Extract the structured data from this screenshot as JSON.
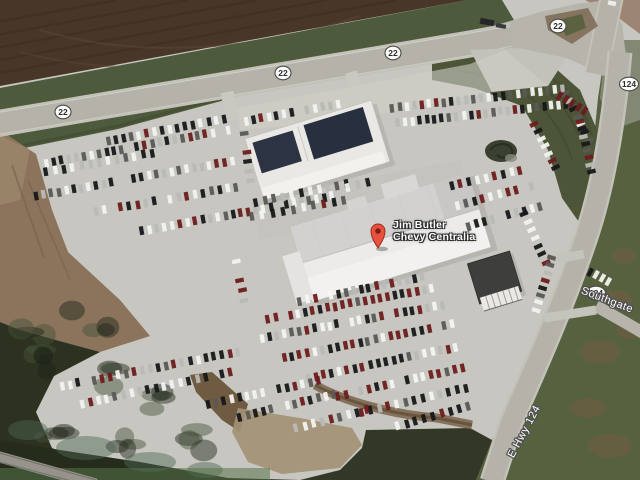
{
  "map": {
    "place_label": {
      "line1": "Jim Butler",
      "line2": "Chevy Centralia"
    },
    "marker": {
      "x": 378,
      "y": 248,
      "color": "#e8513f"
    },
    "route_shields": [
      {
        "label": "22",
        "x": 63,
        "y": 112
      },
      {
        "label": "22",
        "x": 283,
        "y": 73
      },
      {
        "label": "22",
        "x": 393,
        "y": 53
      },
      {
        "label": "22",
        "x": 558,
        "y": 26
      },
      {
        "label": "124",
        "x": 629,
        "y": 84
      },
      {
        "label": "124",
        "x": 596,
        "y": 293
      }
    ],
    "road_labels": [
      {
        "text": "E Hwy 124",
        "x": 527,
        "y": 433,
        "rotate": -62
      },
      {
        "text": "Southgate",
        "x": 606,
        "y": 303,
        "rotate": 21
      }
    ],
    "colors": {
      "marker_red": "#e8513f",
      "marker_red_dark": "#7e1d12",
      "road": "#b4b2a9",
      "road_shoulder": "#c3c1b8",
      "lot": "#c7c6c0",
      "field_brown": "#483728",
      "grass_north": "#4e5a3c",
      "grass_east": "#566140",
      "scrub": "#2c321f",
      "dirt": "#8b745b",
      "roof_white": "#e9e8e4",
      "roof_navy": "#2c3444"
    },
    "car_rows": [
      [
        108,
        141,
        224,
        119,
        16,
        0
      ],
      [
        46,
        163,
        228,
        130,
        25,
        0
      ],
      [
        46,
        172,
        152,
        153,
        13,
        0
      ],
      [
        36,
        196,
        232,
        161,
        27,
        0
      ],
      [
        88,
        213,
        236,
        187,
        19,
        0
      ],
      [
        142,
        231,
        332,
        196,
        26,
        0
      ],
      [
        246,
        121,
        338,
        104,
        13,
        0
      ],
      [
        244,
        134,
        250,
        180,
        6,
        0
      ],
      [
        256,
        202,
        346,
        184,
        11,
        0
      ],
      [
        252,
        217,
        344,
        200,
        10,
        0
      ],
      [
        348,
        187,
        378,
        180,
        4,
        0
      ],
      [
        236,
        262,
        244,
        300,
        5,
        0
      ],
      [
        392,
        108,
        562,
        89,
        24,
        0
      ],
      [
        398,
        123,
        566,
        104,
        24,
        0
      ],
      [
        566,
        93,
        592,
        148,
        8,
        0
      ],
      [
        580,
        122,
        592,
        172,
        8,
        1
      ],
      [
        560,
        96,
        584,
        111,
        5,
        1
      ],
      [
        534,
        124,
        556,
        168,
        7,
        0
      ],
      [
        452,
        186,
        520,
        170,
        9,
        0
      ],
      [
        458,
        205,
        532,
        186,
        10,
        0
      ],
      [
        468,
        226,
        540,
        206,
        10,
        0
      ],
      [
        524,
        214,
        546,
        262,
        7,
        0
      ],
      [
        552,
        258,
        536,
        310,
        8,
        0
      ],
      [
        590,
        272,
        608,
        282,
        4,
        0
      ],
      [
        300,
        301,
        422,
        277,
        17,
        1
      ],
      [
        268,
        319,
        432,
        288,
        23,
        1
      ],
      [
        262,
        338,
        442,
        305,
        25,
        1
      ],
      [
        284,
        358,
        452,
        324,
        23,
        1
      ],
      [
        308,
        378,
        456,
        347,
        20,
        1
      ],
      [
        338,
        396,
        462,
        368,
        17,
        1
      ],
      [
        362,
        412,
        466,
        388,
        13,
        1
      ],
      [
        398,
        426,
        468,
        406,
        9,
        0
      ],
      [
        62,
        386,
        238,
        352,
        23,
        0
      ],
      [
        82,
        404,
        230,
        372,
        19,
        0
      ],
      [
        208,
        404,
        318,
        381,
        15,
        0
      ],
      [
        240,
        417,
        334,
        394,
        13,
        0
      ],
      [
        296,
        428,
        366,
        410,
        9,
        0
      ]
    ]
  }
}
